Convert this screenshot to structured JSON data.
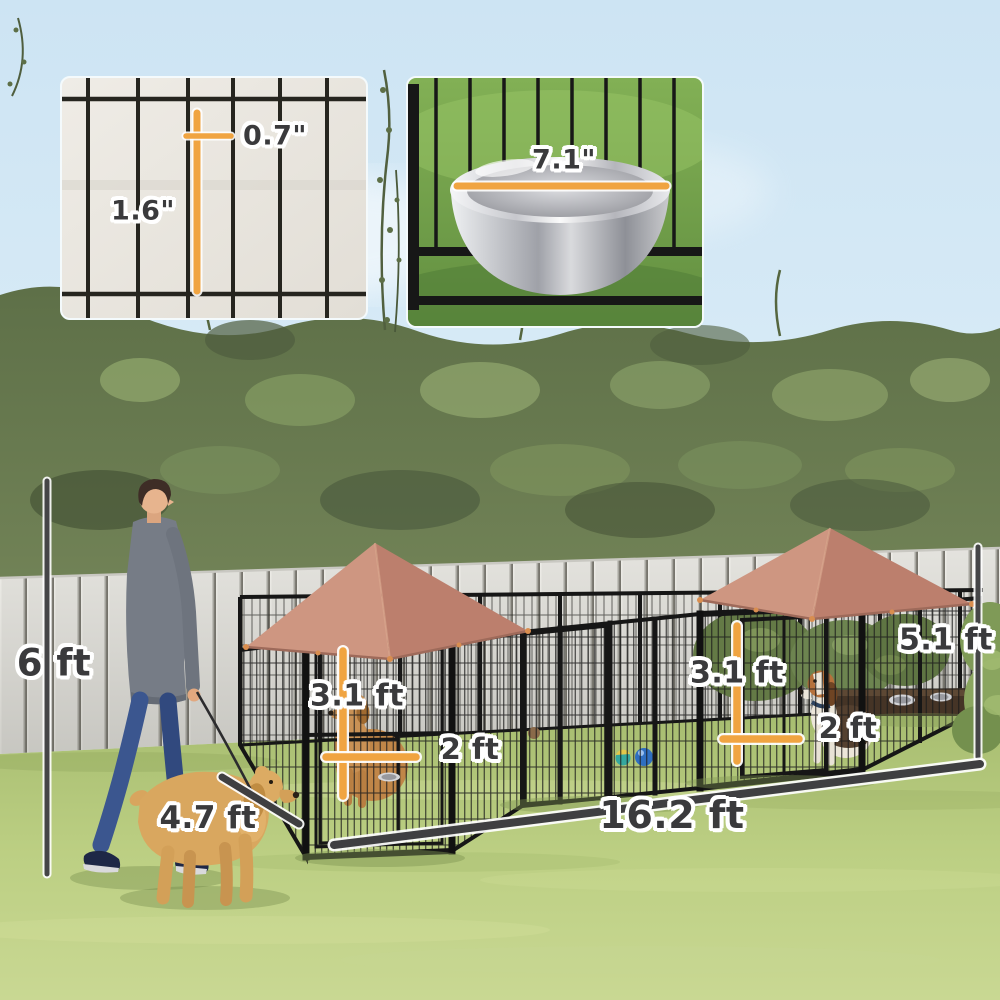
{
  "measurements": {
    "mesh_opening_width": "0.7\"",
    "mesh_opening_height": "1.6\"",
    "bowl_diameter": "7.1\"",
    "fence_height": "6 ft",
    "dog_body_length": "4.7 ft",
    "left_kennel_height": "3.1 ft",
    "left_kennel_door_width": "2 ft",
    "right_kennel_height": "3.1 ft",
    "right_kennel_door_width": "2 ft",
    "canopy_peak_height": "5.1 ft",
    "overall_run_length": "16.2 ft"
  },
  "colors": {
    "accent_measure_orange": "#F0A441",
    "dimension_line_dark": "#3F3F41",
    "label_text": "#3A3A3C",
    "label_outline": "#FFFFFF",
    "canopy_rose": "#C98C79",
    "sky_blue": "#D5E9F5",
    "grass_green": "#B8CC80",
    "fence_gray": "#E3E2DD",
    "kennel_frame_black": "#161616"
  }
}
